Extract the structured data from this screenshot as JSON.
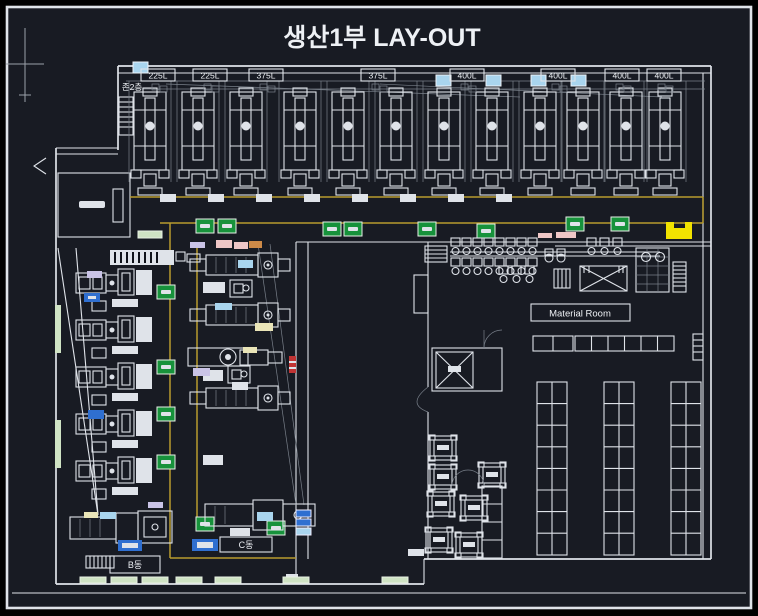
{
  "title": "생산1부 LAY-OUT",
  "top_section": {
    "zone_label": "존2층",
    "machine_labels": [
      "225L",
      "225L",
      "375L",
      "375L",
      "400L",
      "400L",
      "400L",
      "400L"
    ]
  },
  "rooms": {
    "material_room": "Material Room",
    "c_block": "C동",
    "b_block": "B동"
  },
  "colors": {
    "bg": "#181b23",
    "line": "#dfe3e9",
    "dim": "#79808a",
    "text": "#eef1f5",
    "yellow": "#b89b2e",
    "brightyellow": "#f2e300",
    "green": "#17923b",
    "blue": "#2f6fd0",
    "lightblue": "#a9d5ee",
    "palegreen": "#cfe3c4",
    "lavender": "#c9c3e6",
    "paleyellow": "#eae5b8",
    "pink": "#eec6c6",
    "red": "#c03434",
    "orange": "#cd8a48"
  }
}
